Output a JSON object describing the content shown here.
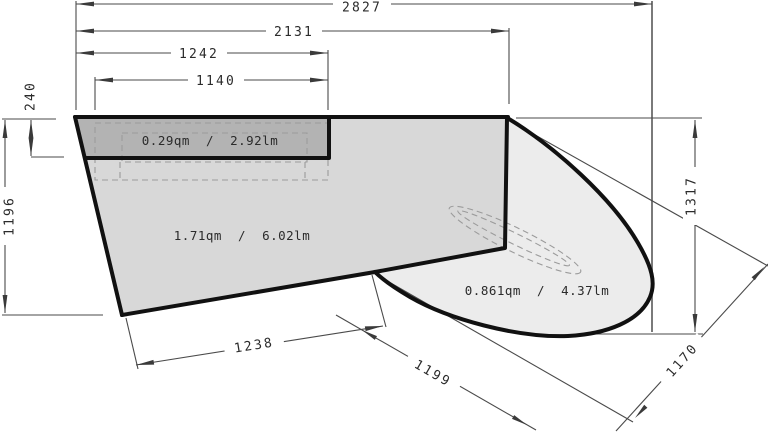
{
  "drawing": {
    "type_note": "dimensioned panel plan",
    "dimensions": {
      "total_width": "2827",
      "corner_width": "2131",
      "strip_width": "1242",
      "recess_width": "1140",
      "strip_height": "240",
      "left_height": "1196",
      "right_height": "1317",
      "bottom_edge_length": "1238",
      "diagonal_edge_length": "1199",
      "bay_width": "1170"
    },
    "areas": {
      "strip_label": "0.29qm  /  2.92lm",
      "main_label": "1.71qm  /  6.02lm",
      "bay_label": "0.861qm  /  4.37lm"
    },
    "colors": {
      "strip_fill": "#b3b3b3",
      "main_fill": "#d8d8d8",
      "bay_fill": "#ececec",
      "outline": "#111111",
      "dim_lines": "#4a4a4a"
    }
  }
}
